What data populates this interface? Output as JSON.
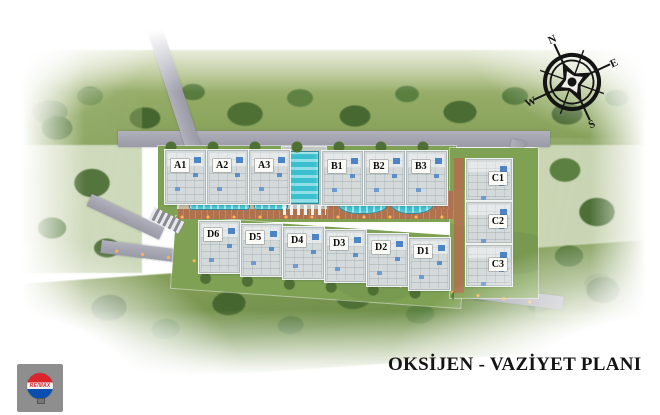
{
  "title": "OKSİJEN - VAZİYET PLANI",
  "compass": {
    "n": "N",
    "e": "E",
    "s": "S",
    "w": "W"
  },
  "logo": {
    "brand": "RE/MAX"
  },
  "buildings": {
    "A": [
      "A1",
      "A2",
      "A3"
    ],
    "B": [
      "B1",
      "B2",
      "B3"
    ],
    "C": [
      "C1",
      "C2",
      "C3"
    ],
    "D": [
      "D6",
      "D5",
      "D4",
      "D3",
      "D2",
      "D1"
    ]
  },
  "colors": {
    "pool": "#3bbfce",
    "grass": "#7ea153",
    "road": "#a5a6b1",
    "accent_brick": "#b0714e",
    "title_color": "#141414",
    "logo_red": "#d9252b",
    "logo_blue": "#0a4fae"
  }
}
